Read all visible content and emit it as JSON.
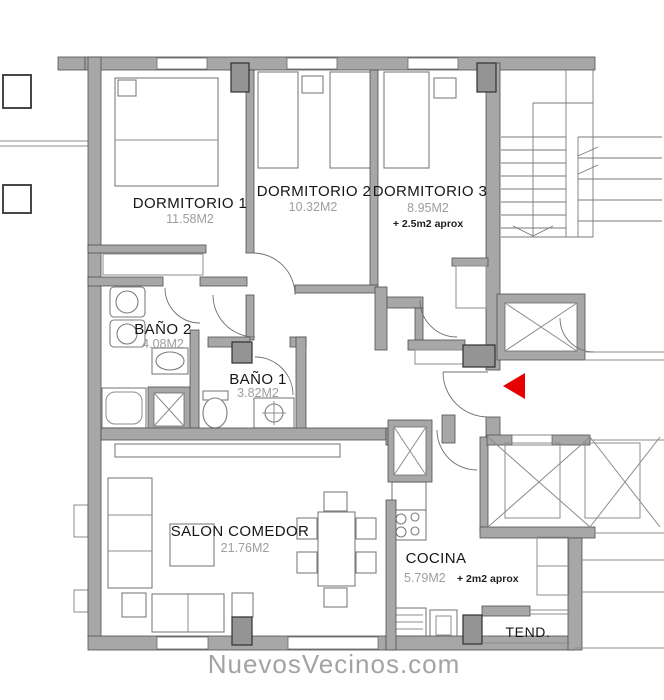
{
  "watermark": {
    "text": "NuevosVecinos.com",
    "color": "#a3a3a3"
  },
  "rooms": [
    {
      "id": "dormitorio-1",
      "name": "DORMITORIO 1",
      "area": "11.58M2",
      "extra": ""
    },
    {
      "id": "dormitorio-2",
      "name": "DORMITORIO 2",
      "area": "10.32M2",
      "extra": ""
    },
    {
      "id": "dormitorio-3",
      "name": "DORMITORIO 3",
      "area": "8.95M2",
      "extra": "+ 2.5m2 aprox"
    },
    {
      "id": "bano-2",
      "name": "BAÑO 2",
      "area": "4.08M2",
      "extra": ""
    },
    {
      "id": "bano-1",
      "name": "BAÑO 1",
      "area": "3.82M2",
      "extra": ""
    },
    {
      "id": "salon-comedor",
      "name": "SALON COMEDOR",
      "area": "21.76M2",
      "extra": ""
    },
    {
      "id": "cocina",
      "name": "COCINA",
      "area": "5.79M2",
      "extra": "+ 2m2 aprox"
    },
    {
      "id": "tendedero",
      "name": "TEND.",
      "area": "",
      "extra": ""
    }
  ],
  "entrance_arrow": {
    "direction": "left",
    "color": "#e60000"
  },
  "colors": {
    "wall": "#a7a7a7",
    "column": "#949494",
    "outline": "#4f4f4f",
    "thin_line": "#8c8c8c",
    "room_text": "#161616",
    "area_text": "#9e9e9e",
    "arrow": "#e60000",
    "watermark": "#a3a3a3"
  }
}
